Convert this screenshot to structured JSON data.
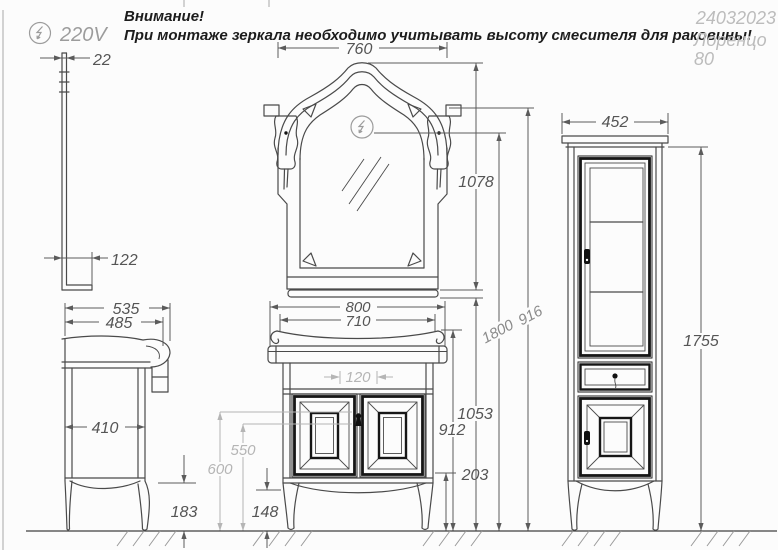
{
  "power": {
    "voltage": "220V"
  },
  "warning": {
    "title": "Внимание!",
    "text": "При монтаже зеркала необходимо учитывать высоту смесителя для раковины!"
  },
  "title_block": {
    "doc_number": "24032023",
    "model": "Лоренцо",
    "size": "80"
  },
  "dims": {
    "mirror_thickness": "22",
    "mirror_shelf_depth": "122",
    "mirror_width": "760",
    "mirror_height": "1078",
    "outlet_height": "1800",
    "mirror_top_height": "1916",
    "side_depth_total": "535",
    "side_depth_top": "485",
    "side_inner_depth": "410",
    "side_leg_height": "183",
    "vanity_width": "800",
    "vanity_body_width": "710",
    "drain_width": "120",
    "keyhole_height": "550",
    "keyhole_top_height": "600",
    "front_leg_height": "148",
    "bottom_gap": "203",
    "vanity_height": "912",
    "mirror_shelf_height": "1053",
    "cabinet_width": "452",
    "cabinet_height": "1755"
  },
  "colors": {
    "line": "#4a4a4a",
    "dim_text": "#555555",
    "gray_dim": "#b5b5b5",
    "muted": "#9c9c9c",
    "title_gray": "#bcbcbc",
    "background": "#fcfcfc"
  }
}
